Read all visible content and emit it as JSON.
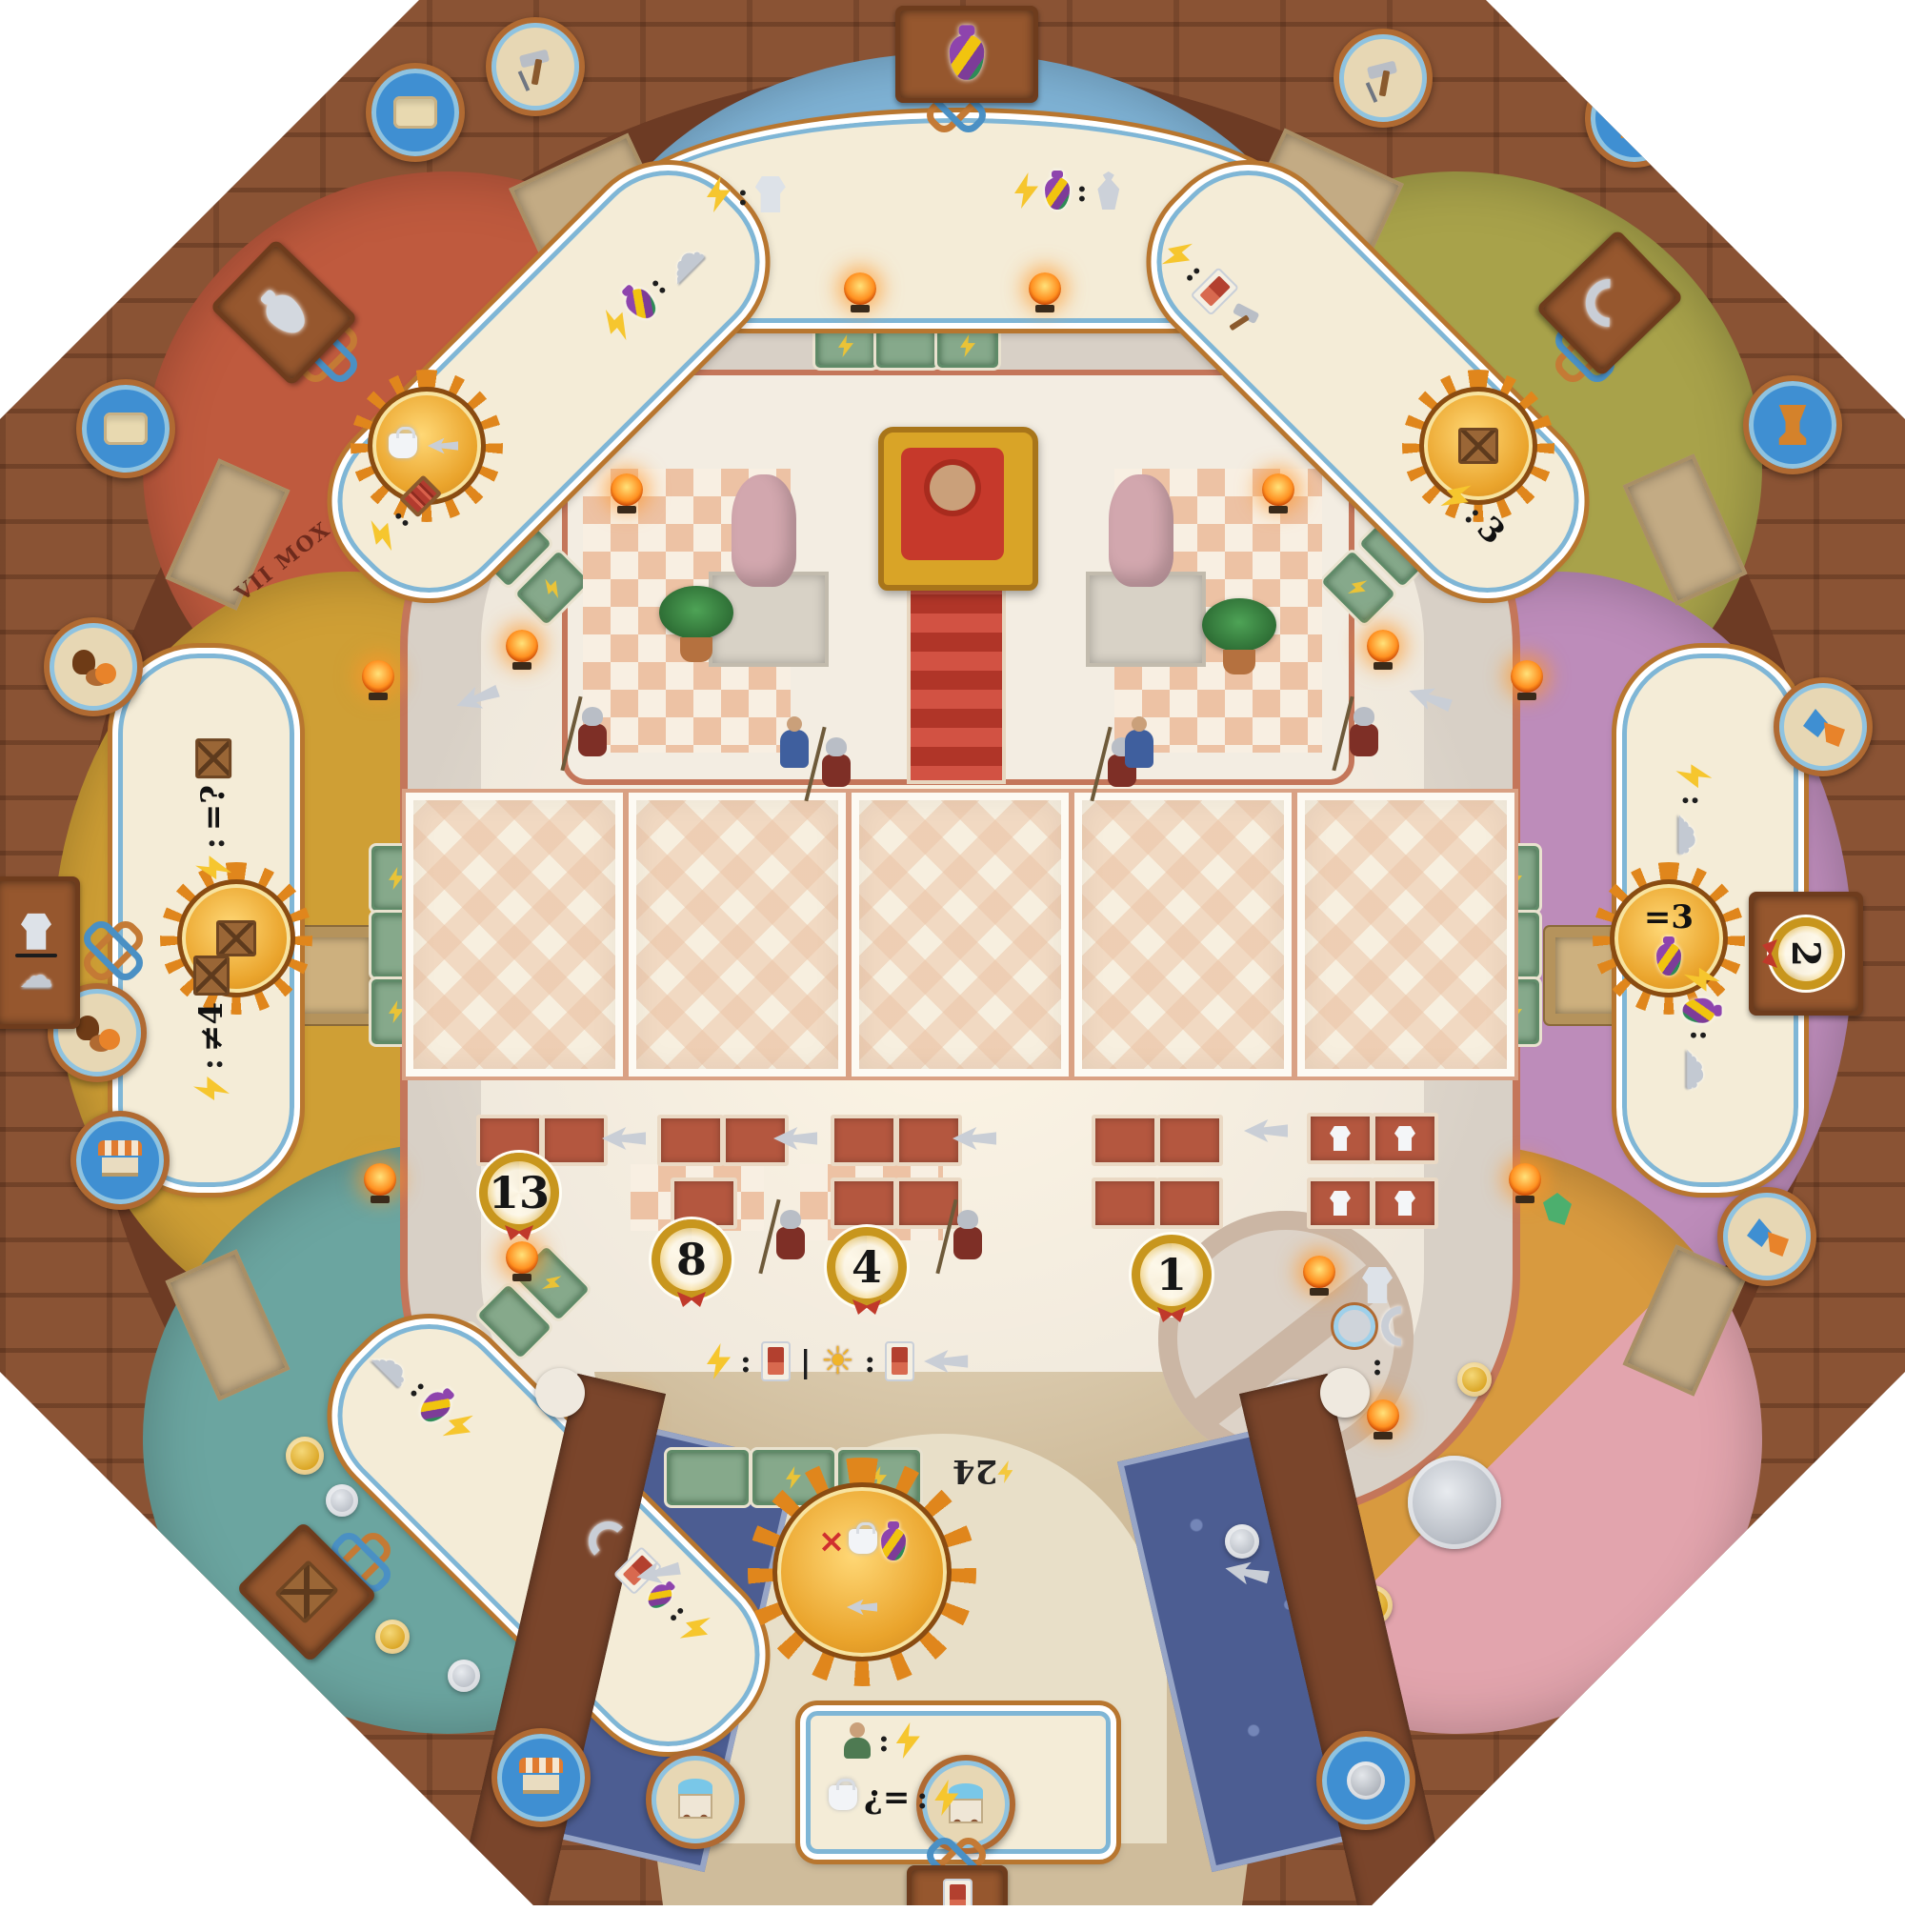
{
  "numbers": {
    "thirteen": "13",
    "eight": "8",
    "four": "4",
    "one": "1",
    "two": "2",
    "twentyfour": "24"
  },
  "ops": {
    "colon": ":",
    "pipe": "|",
    "eq_unknown": "=?",
    "neq_four": "≠4",
    "eq_three": "=3",
    "three": "3",
    "inv_eq": "¿=",
    "cross": "×"
  },
  "icons": {
    "cloud": "☁",
    "sun": "☀"
  },
  "graffiti": {
    "line1": "VII",
    "line2": "MOX",
    "line3": "XII"
  },
  "colors": {
    "brick_border": "#8a5334",
    "arch_ring": "#6d3b24",
    "hall_floor": "#d8d0c6",
    "court_floor": "#efe8dc",
    "workshop_sculptor": "#7fb3d6",
    "workshop_pottery": "#bf5a3e",
    "workshop_produce": "#a8a24a",
    "workshop_warehouse": "#cf9f35",
    "workshop_cloth": "#bd8cba",
    "workshop_trade": "#6ba5a0",
    "workshop_treasury": "#d89a3f",
    "water_channel": "#4c5d92",
    "space_green": "#86a98b",
    "space_red": "#b4573f",
    "banner_cream": "#f4ecd7",
    "sun_gold": "#eaa42c",
    "bolt_yellow": "#f6c62e",
    "wreath_gold": "#c8961d"
  }
}
